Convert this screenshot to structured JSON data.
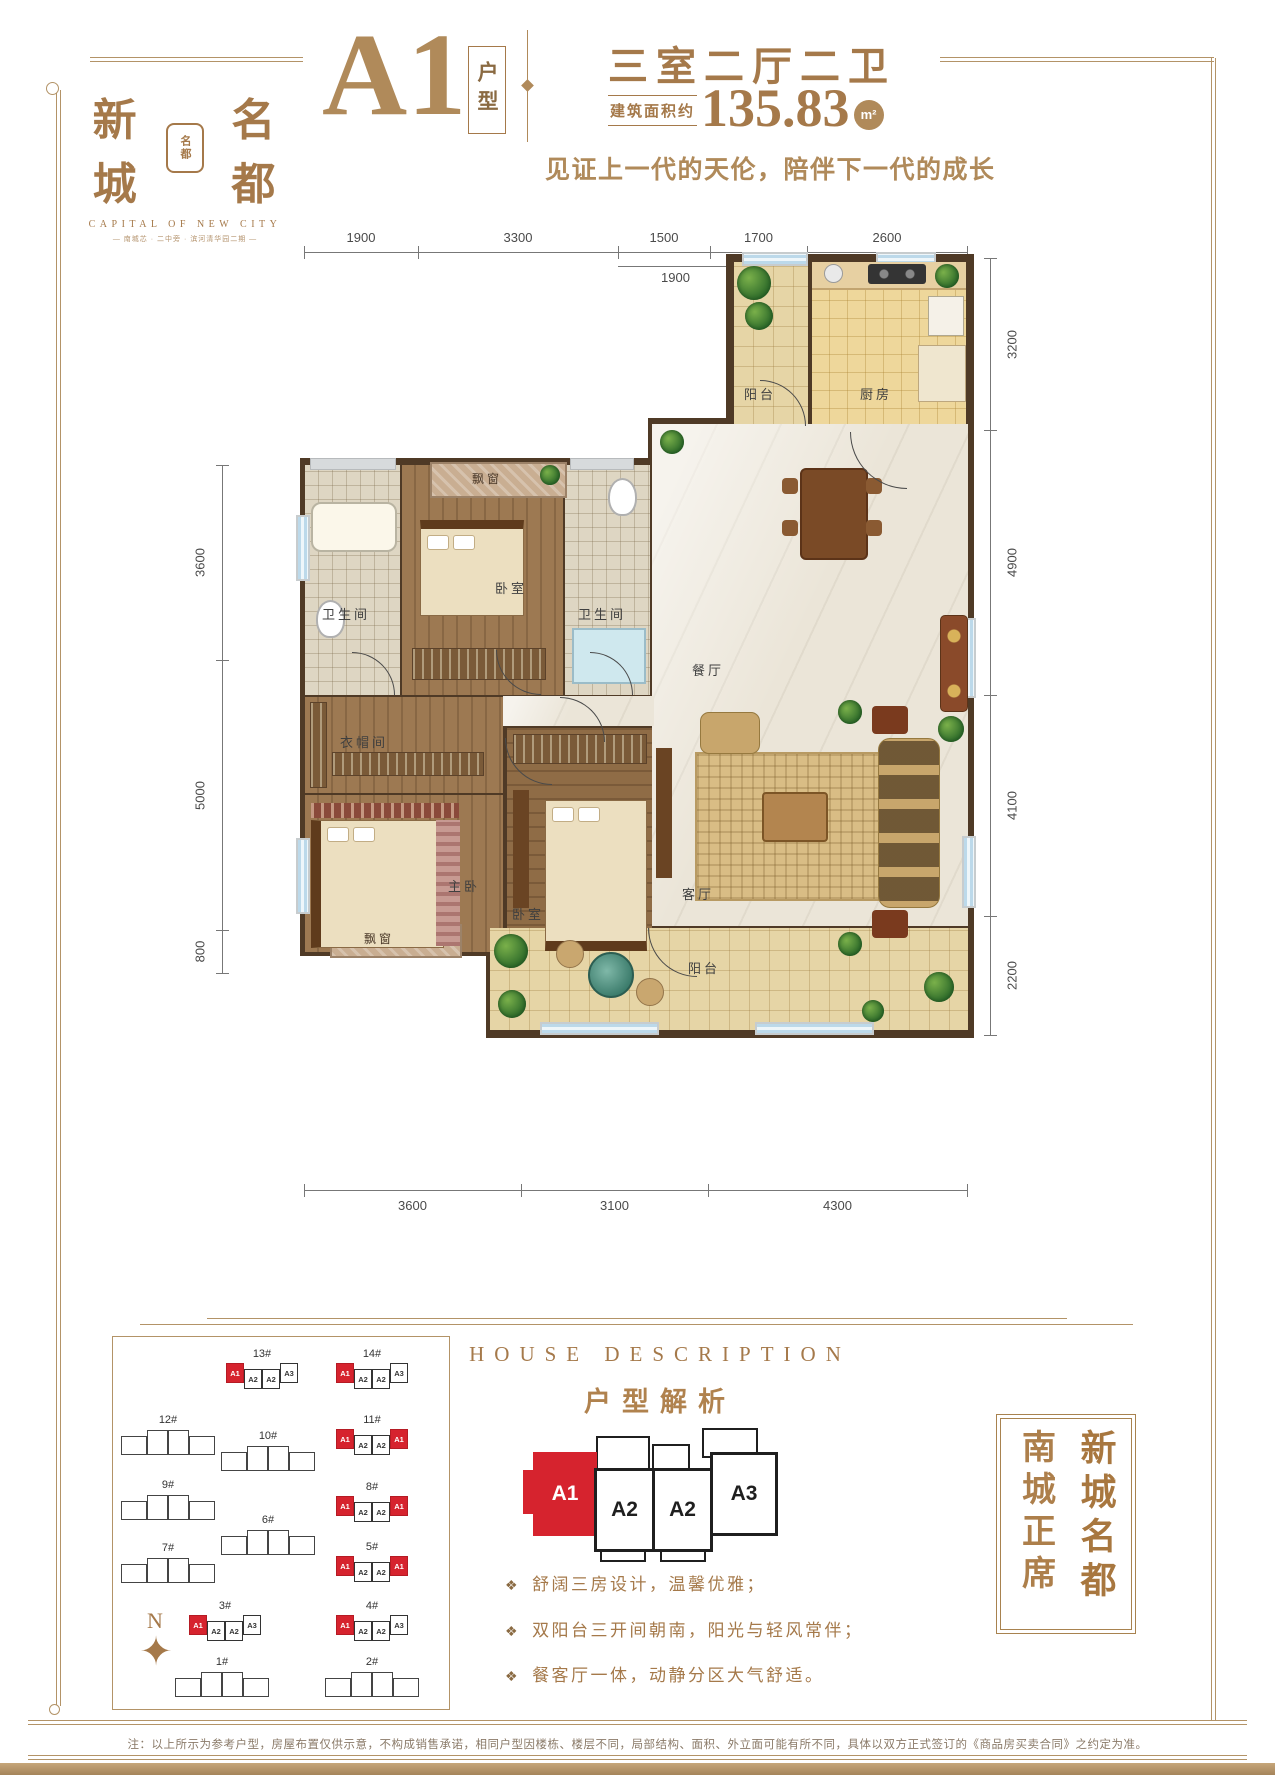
{
  "header": {
    "logo": {
      "brand_left": "新城",
      "brand_right": "名都",
      "seal_text": "名都",
      "english": "CAPITAL OF NEW CITY",
      "sub_tagline": "— 南城芯 · 二中旁 · 滨河清华园二期 —"
    },
    "unit_code": "A1",
    "unit_code_suffix": "户型",
    "layout_title": "三室二厅二卫",
    "area_prefix": "建筑面积约",
    "area_value": "135.83",
    "area_unit": "m²",
    "slogan": "见证上一代的天伦，陪伴下一代的成长"
  },
  "plan": {
    "dims_top": [
      "1900",
      "3300",
      "1500",
      "1700",
      "2600"
    ],
    "dims_top_sub": "1900",
    "dims_left": [
      "3600",
      "5000",
      "800"
    ],
    "dims_right": [
      "3200",
      "4900",
      "4100",
      "2200"
    ],
    "dims_bottom": [
      "3600",
      "3100",
      "4300"
    ],
    "rooms": {
      "balcony_top": "阳台",
      "kitchen": "厨房",
      "bath1": "卫生间",
      "bedroom_top": "卧室",
      "bath2": "卫生间",
      "dining": "餐厅",
      "cloakroom": "衣帽间",
      "master": "主卧",
      "bedroom2": "卧室",
      "living": "客厅",
      "balcony_bottom": "阳台",
      "bay_top": "飘窗",
      "bay_bottom": "飘窗"
    }
  },
  "description": {
    "heading_en": "HOUSE DESCRIPTION",
    "heading_cn": "户型解析",
    "units": [
      "A1",
      "A2",
      "A2",
      "A3"
    ],
    "bullet_icon": "❖",
    "bullets": [
      "舒阔三房设计，温馨优雅；",
      "双阳台三开间朝南，阳光与轻风常伴；",
      "餐客厅一体，动静分区大气舒适。"
    ]
  },
  "site": {
    "compass": "N",
    "buildings": [
      {
        "name": "13#",
        "units": [
          "A1",
          "A2",
          "A2",
          "A3"
        ]
      },
      {
        "name": "14#",
        "units": [
          "A1",
          "A2",
          "A2",
          "A3"
        ]
      },
      {
        "name": "12#"
      },
      {
        "name": "10#"
      },
      {
        "name": "11#",
        "units": [
          "A1",
          "A2",
          "A2",
          "A1"
        ]
      },
      {
        "name": "9#"
      },
      {
        "name": "8#",
        "units": [
          "A1",
          "A2",
          "A2",
          "A1"
        ]
      },
      {
        "name": "6#"
      },
      {
        "name": "7#"
      },
      {
        "name": "5#",
        "units": [
          "A1",
          "A2",
          "A2",
          "A1"
        ]
      },
      {
        "name": "3#",
        "units": [
          "A1",
          "A2",
          "A2",
          "A3"
        ]
      },
      {
        "name": "4#",
        "units": [
          "A1",
          "A2",
          "A2",
          "A3"
        ]
      },
      {
        "name": "1#"
      },
      {
        "name": "2#"
      }
    ]
  },
  "banner": {
    "col_left": "南城正席",
    "col_right": "新城名都"
  },
  "footer": {
    "note": "注：以上所示为参考户型，房屋布置仅供示意，不构成销售承诺，相同户型因楼栋、楼层不同，局部结构、面积、外立面可能有所不同，具体以双方正式签订的《商品房买卖合同》之约定为准。"
  },
  "colors": {
    "brand_gold": "#a5794a",
    "accent_gold": "#b08a5a",
    "highlight_red": "#d6232e",
    "wall_dark": "#4f3a26",
    "frame_line": "#b39367"
  }
}
